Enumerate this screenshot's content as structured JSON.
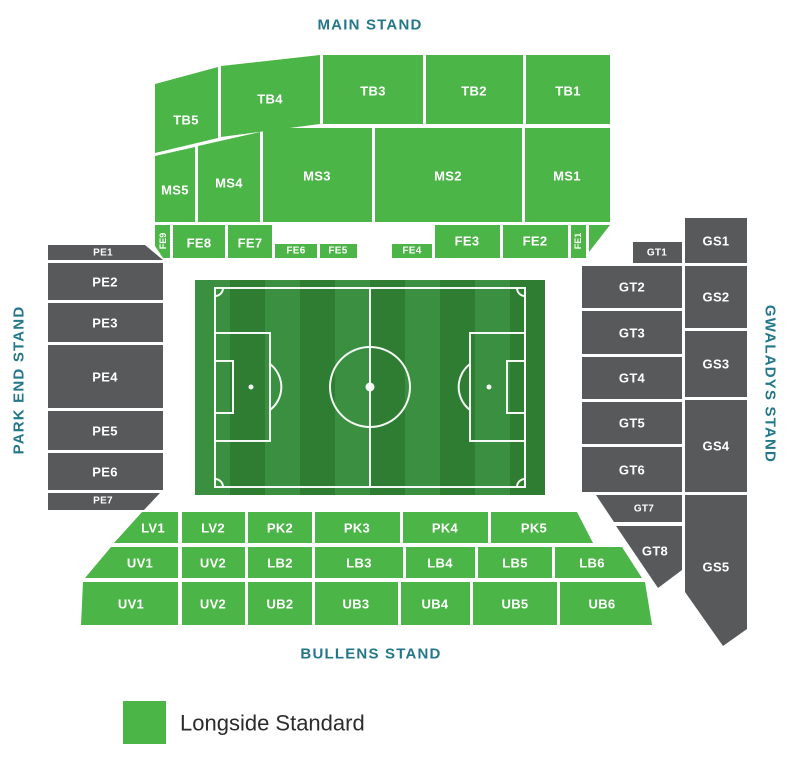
{
  "stands": {
    "main": {
      "title": "MAIN STAND",
      "sections": {
        "tb5": "TB5",
        "tb4": "TB4",
        "tb3": "TB3",
        "tb2": "TB2",
        "tb1": "TB1",
        "ms5": "MS5",
        "ms4": "MS4",
        "ms3": "MS3",
        "ms2": "MS2",
        "ms1": "MS1",
        "fe9": "FE9",
        "fe8": "FE8",
        "fe7": "FE7",
        "fe6": "FE6",
        "fe5": "FE5",
        "fe4": "FE4",
        "fe3": "FE3",
        "fe2": "FE2",
        "fe1": "FE1"
      }
    },
    "park_end": {
      "title": "PARK END STAND",
      "sections": {
        "pe1": "PE1",
        "pe2": "PE2",
        "pe3": "PE3",
        "pe4": "PE4",
        "pe5": "PE5",
        "pe6": "PE6",
        "pe7": "PE7"
      }
    },
    "gwaladys": {
      "title": "GWALADYS STAND",
      "sections": {
        "gt1": "GT1",
        "gt2": "GT2",
        "gt3": "GT3",
        "gt4": "GT4",
        "gt5": "GT5",
        "gt6": "GT6",
        "gt7": "GT7",
        "gt8": "GT8",
        "gs1": "GS1",
        "gs2": "GS2",
        "gs3": "GS3",
        "gs4": "GS4",
        "gs5": "GS5"
      }
    },
    "bullens": {
      "title": "BULLENS STAND",
      "sections": {
        "lv1": "LV1",
        "lv2": "LV2",
        "pk2": "PK2",
        "pk3": "PK3",
        "pk4": "PK4",
        "pk5": "PK5",
        "uv1_upper": "UV1",
        "uv2_upper": "UV2",
        "lb2": "LB2",
        "lb3": "LB3",
        "lb4": "LB4",
        "lb5": "LB5",
        "lb6": "LB6",
        "uv1_lower": "UV1",
        "uv2_lower": "UV2",
        "ub2": "UB2",
        "ub3": "UB3",
        "ub4": "UB4",
        "ub5": "UB5",
        "ub6": "UB6"
      }
    }
  },
  "legend": {
    "items": [
      {
        "label": "Longside Standard",
        "color": "#4cb548"
      }
    ]
  },
  "colors": {
    "longside_standard_green": "#4cb548",
    "unavailable_gray": "#58595b",
    "stand_title_teal": "#237789",
    "pitch_green_dark": "#2f7c33",
    "pitch_green_light": "#3a9040"
  }
}
